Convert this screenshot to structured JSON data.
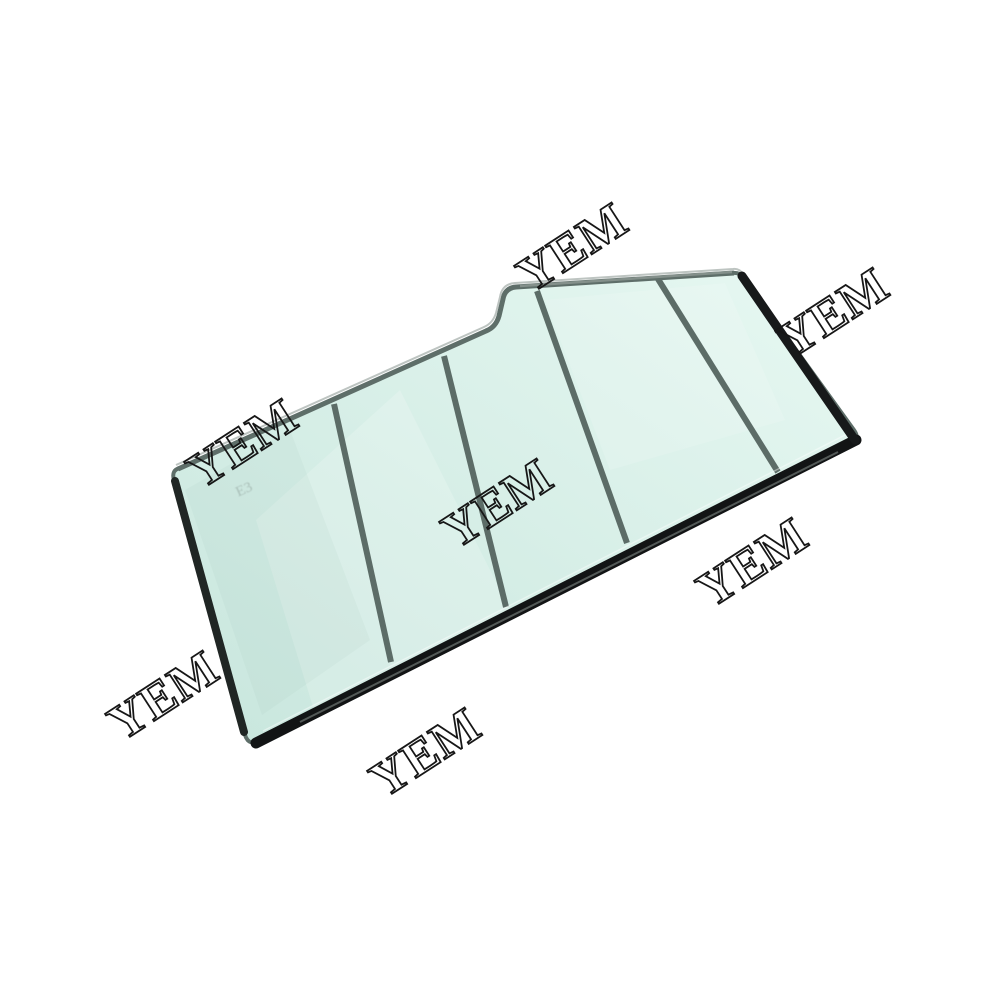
{
  "image": {
    "description": "product photo of a tinted multi-pane cab glass window panel on a white background",
    "background_color": "#ffffff"
  },
  "watermark": {
    "text": "YEM",
    "stroke_color": "#161616",
    "rotation_deg": -33,
    "font_size_px": 50,
    "instances": [
      {
        "cx": 572,
        "cy": 247
      },
      {
        "cx": 833,
        "cy": 312
      },
      {
        "cx": 242,
        "cy": 443
      },
      {
        "cx": 497,
        "cy": 503
      },
      {
        "cx": 752,
        "cy": 562
      },
      {
        "cx": 163,
        "cy": 695
      },
      {
        "cx": 425,
        "cy": 752
      }
    ]
  },
  "panel": {
    "glass_gradient_start": "#c8e6dd",
    "glass_gradient_end": "#e7f8f2",
    "seal_color": "#5e6e69",
    "seal_highlight_color": "#b6beba",
    "seal_light_color": "#8d9893",
    "edge_dark_color": "#17191a",
    "bottom_edge_color": "#121415",
    "band_seam_color": "#6a706d",
    "left_edge_color": "#202624",
    "divider_color": "#5c6c67",
    "divider_count": 4,
    "section_count": 5
  },
  "glass_marking": {
    "text": "E3",
    "color": "#8fa09a"
  }
}
